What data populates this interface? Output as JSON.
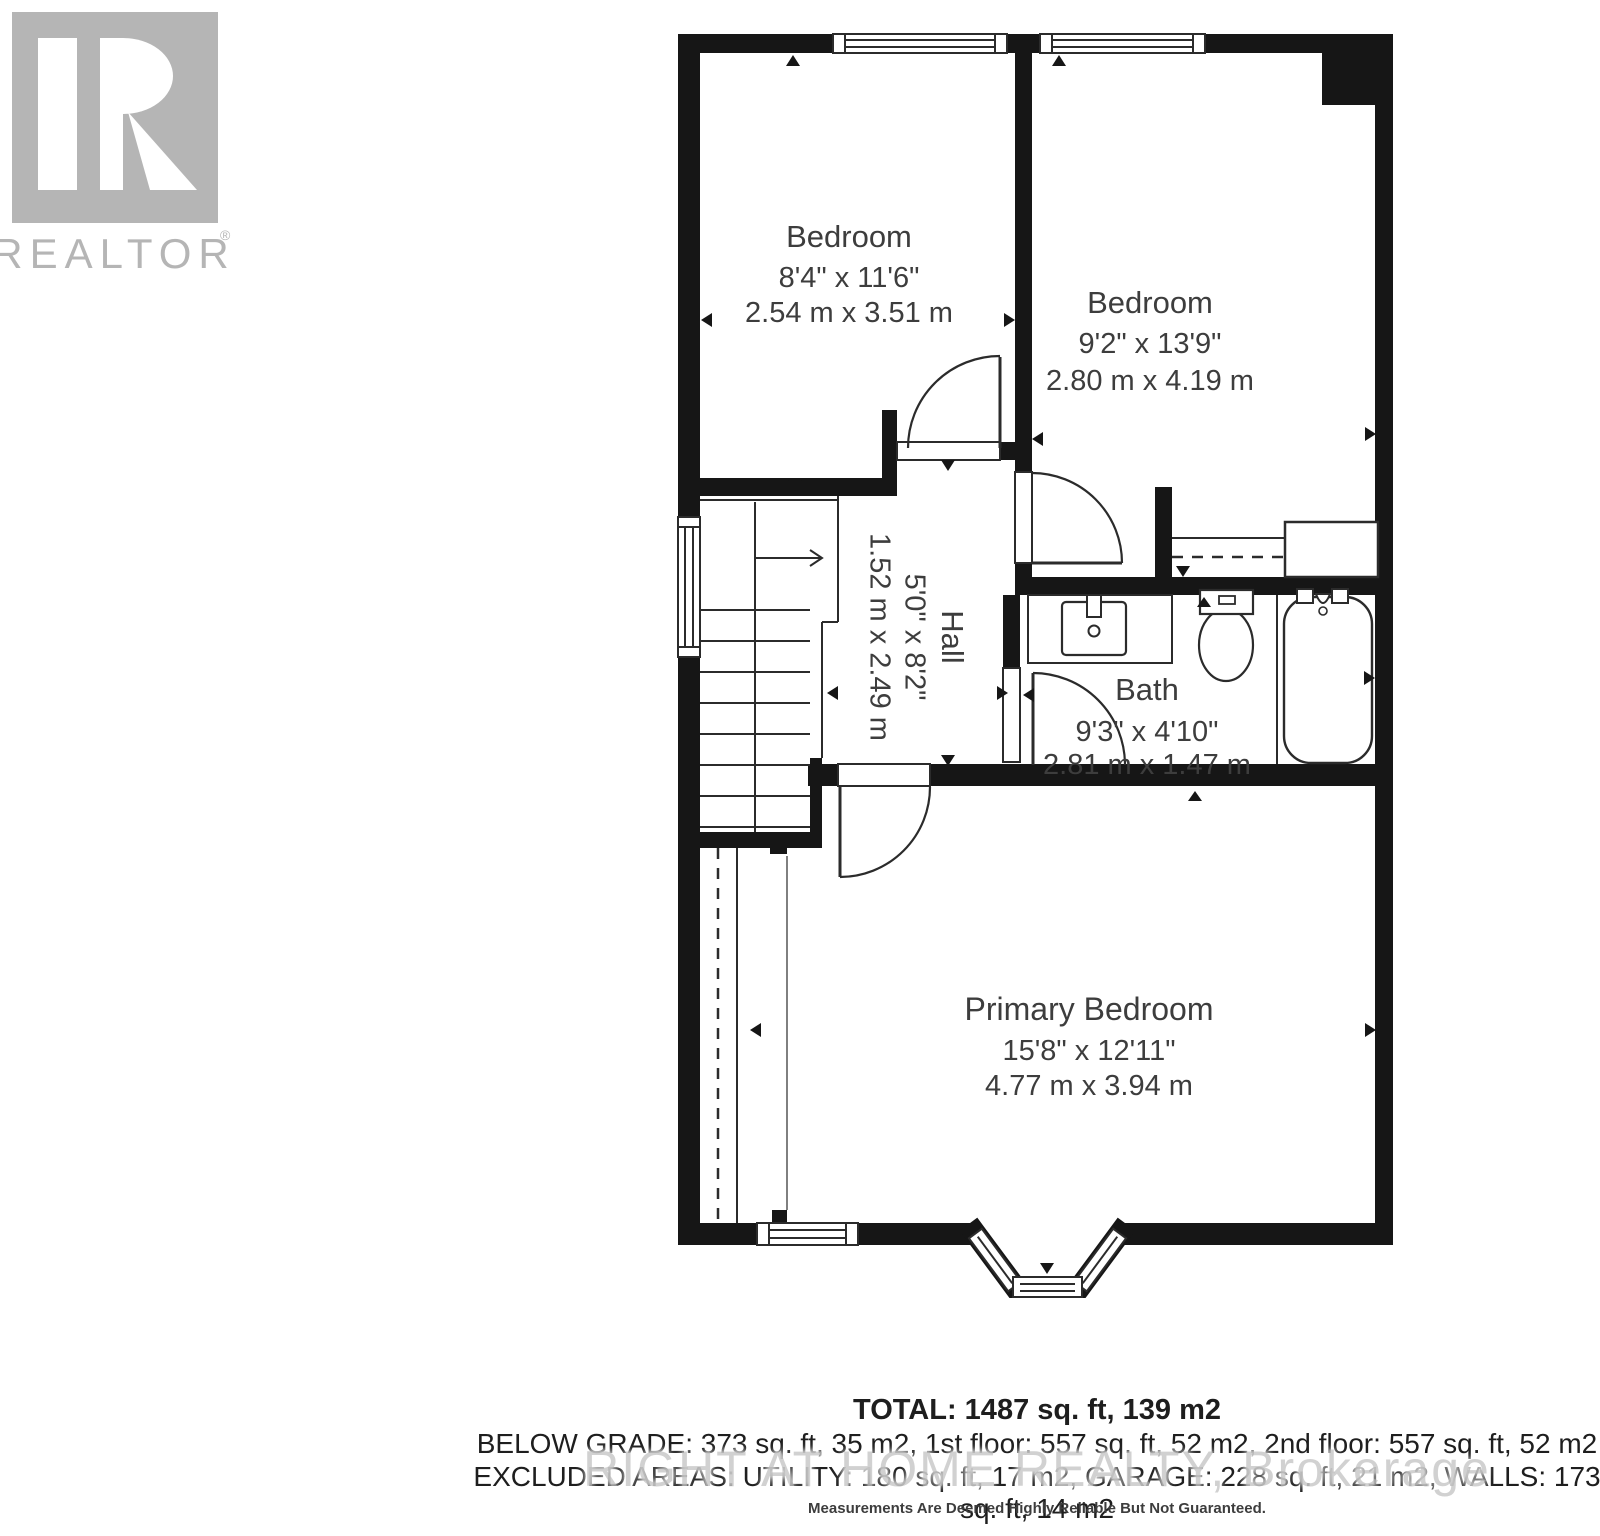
{
  "branding": {
    "logo_text": "REALTOR",
    "reg": "®"
  },
  "rooms": [
    {
      "name": "Bedroom",
      "imperial": "8'4\" x 11'6\"",
      "metric": "2.54 m x 3.51 m"
    },
    {
      "name": "Bedroom",
      "imperial": "9'2\" x 13'9\"",
      "metric": "2.80 m x 4.19 m"
    },
    {
      "name": "Hall",
      "imperial": "5'0\" x 8'2\"",
      "metric": "1.52 m x 2.49 m"
    },
    {
      "name": "Bath",
      "imperial": "9'3\" x 4'10\"",
      "metric": "2.81 m x 1.47 m"
    },
    {
      "name": "Primary Bedroom",
      "imperial": "15'8\" x 12'11\"",
      "metric": "4.77 m x 3.94 m"
    }
  ],
  "summary": {
    "total": "TOTAL: 1487 sq. ft, 139 m2",
    "below_grade": "BELOW GRADE: 373 sq. ft, 35 m2, 1st floor: 557 sq. ft, 52 m2, 2nd floor: 557 sq. ft, 52 m2",
    "excluded": "EXCLUDED AREAS: UTILITY: 180 sq. ft, 17 m2, GARAGE: 228 sq. ft, 21 m2, WALLS: 173 sq. ft, 14 m2",
    "disclaimer": "Measurements Are Deemed Highly Reliable But Not Guaranteed."
  },
  "watermark": {
    "text": "RIGHT AT HOME REALTY, Brokerage"
  },
  "colors": {
    "wall": "#161616",
    "line": "#2b2b2b",
    "text": "#3d3d3d",
    "logo_gray": "#b5b5b5",
    "watermark_gray": "#c6c6c6"
  }
}
